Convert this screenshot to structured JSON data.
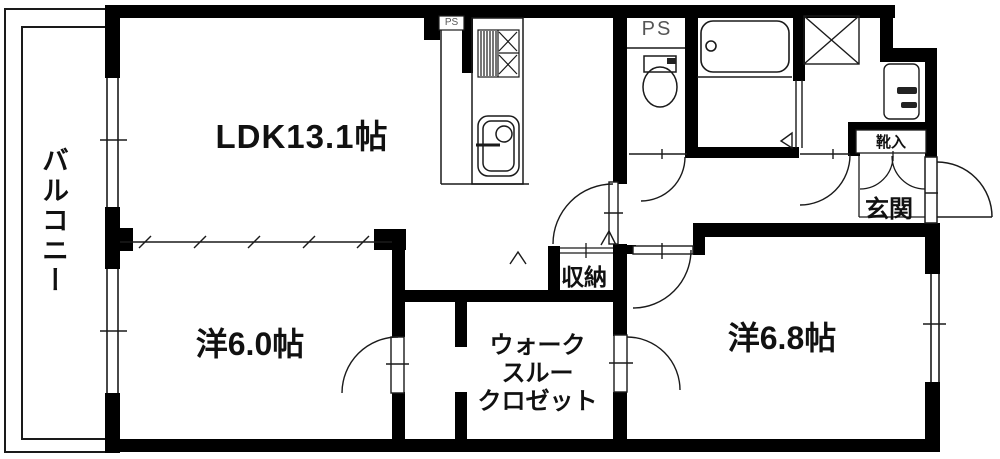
{
  "floorplan": {
    "background": "#ffffff",
    "wall_color": "#000000",
    "line_color": "#1a1a1a",
    "labels": {
      "balcony": "バルコニー",
      "ldk": "LDK13.1帖",
      "western_room_small": "洋6.0帖",
      "western_room_large": "洋6.8帖",
      "walk_through_closet": [
        "ウォーク",
        "スルー",
        "クロゼット"
      ],
      "storage": "収納",
      "entrance": "玄関",
      "shoe_cabinet": "靴入",
      "pipe_space_kitchen": "PS",
      "pipe_space_toilet": "PS"
    }
  }
}
